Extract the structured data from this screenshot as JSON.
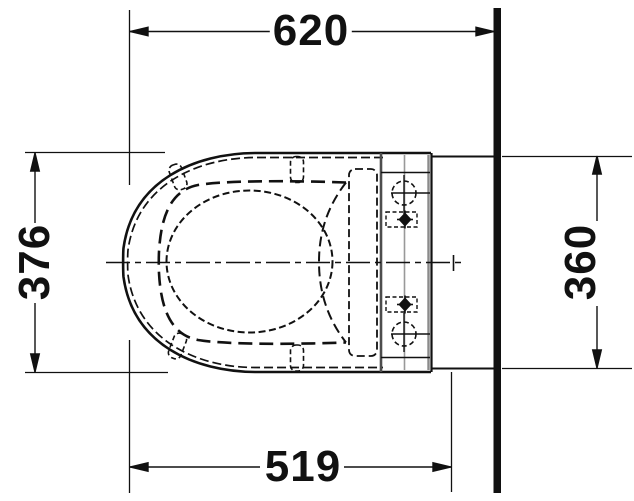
{
  "drawing_title": "wall-hung-toilet-top-view",
  "dimensions": {
    "top": {
      "label": "620",
      "orientation": "horizontal"
    },
    "bottom": {
      "label": "519",
      "orientation": "horizontal"
    },
    "left": {
      "label": "376",
      "orientation": "vertical"
    },
    "right": {
      "label": "360",
      "orientation": "vertical"
    }
  },
  "colors": {
    "line": "#111111",
    "gray_line": "#8a8a8a",
    "dark_gray_line": "#4d4d4d",
    "background": "#ffffff"
  }
}
